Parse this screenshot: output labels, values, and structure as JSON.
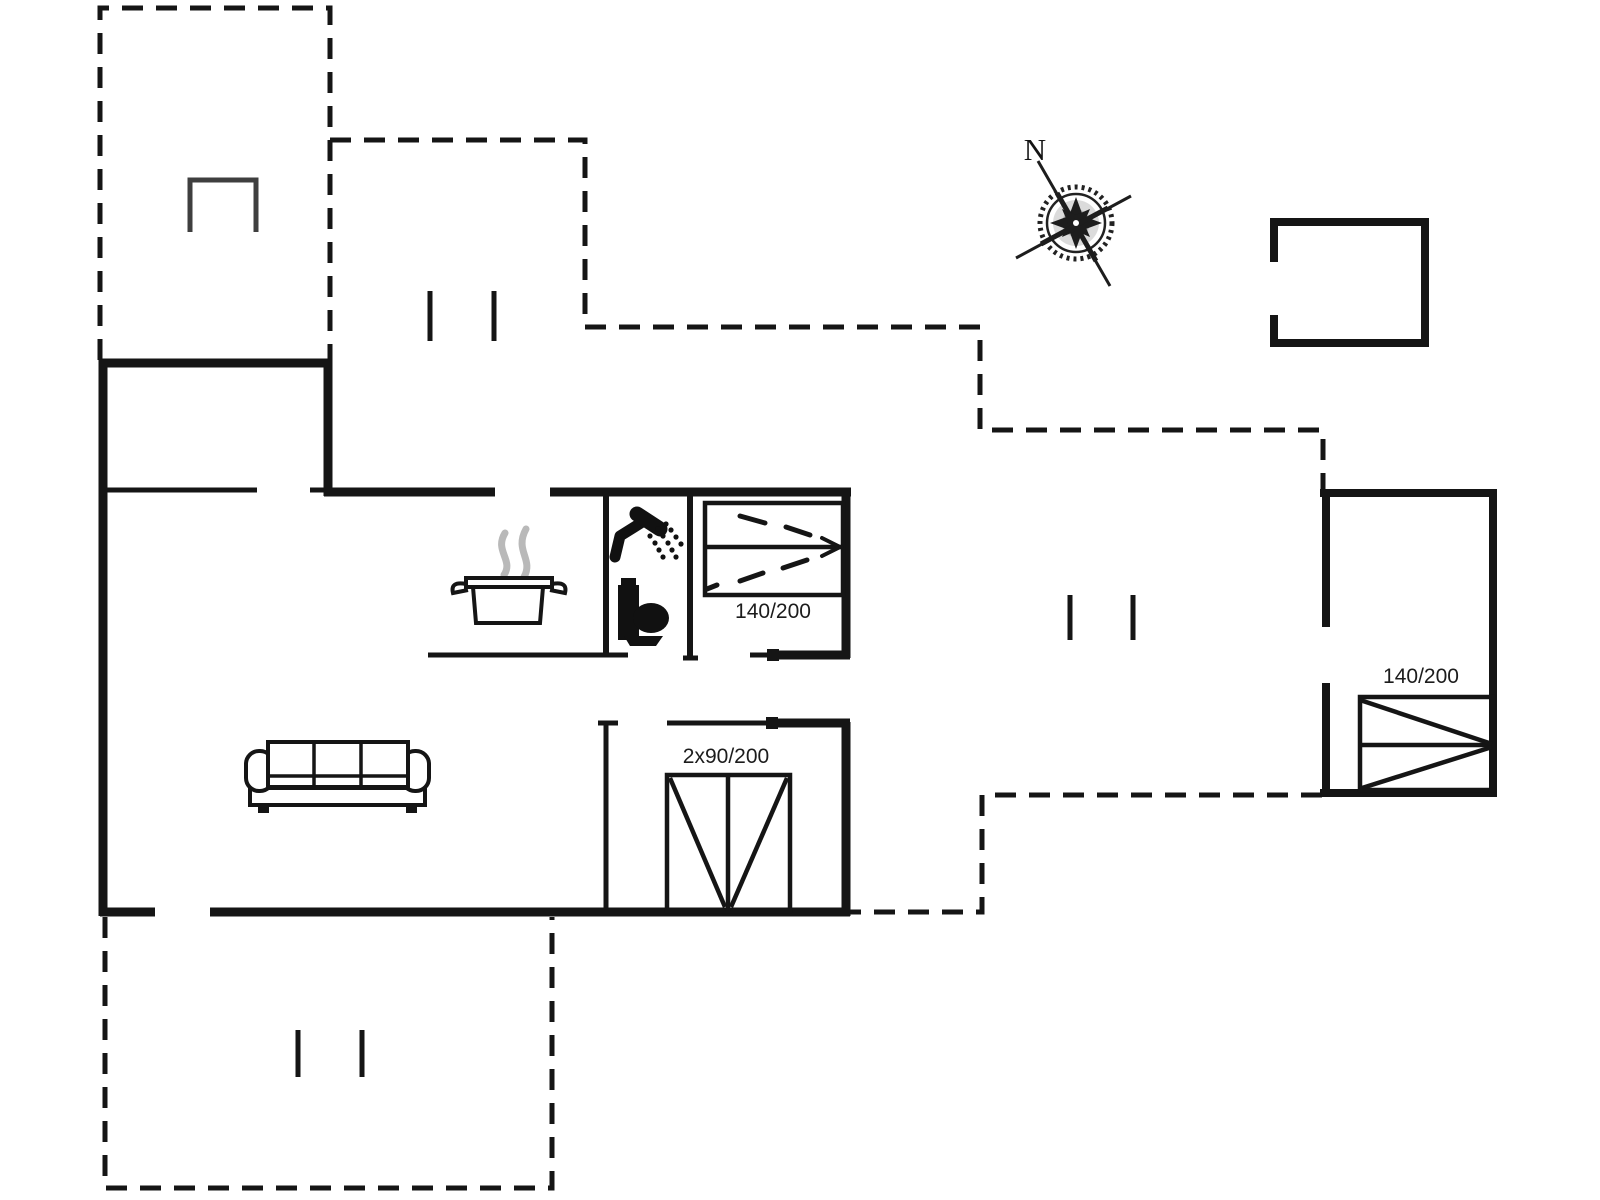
{
  "document": {
    "type": "floor-plan",
    "style": "black line drawing on white"
  },
  "compass": {
    "label": "N"
  },
  "beds": [
    {
      "id": "bedroom-inner",
      "label": "140/200"
    },
    {
      "id": "bedroom-annex",
      "label": "140/200"
    },
    {
      "id": "bedroom-double",
      "label": "2x90/200"
    }
  ],
  "icons": [
    "compass-rose-icon",
    "cooking-pot-icon",
    "steam-icon",
    "shower-icon",
    "toilet-icon",
    "sofa-icon",
    "grill-icon",
    "window-marker-icon",
    "bed-symbol"
  ],
  "colors": {
    "wall_line": "#151515",
    "steam": "#b9b9b9",
    "grill": "#3f3f3f",
    "background": "#ffffff"
  }
}
